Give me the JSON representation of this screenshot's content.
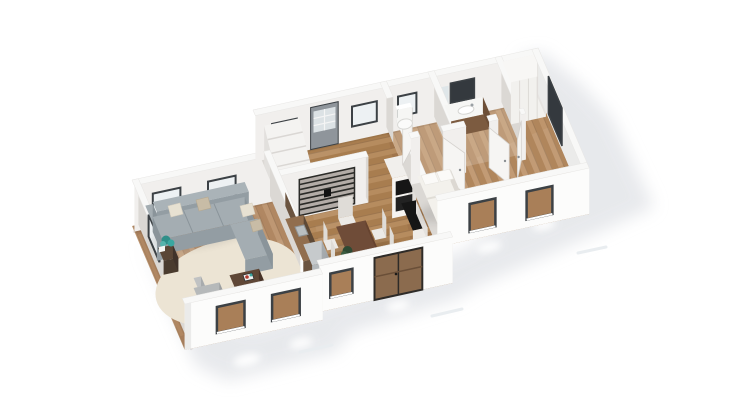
{
  "scene": {
    "title": "3D isometric floor plan rendering of a single-story home",
    "view": "birds-eye axonometric cutaway",
    "background": "#ffffff"
  },
  "rooms": [
    {
      "id": "living-room",
      "furniture": [
        "corner-sofa",
        "throw-pillows",
        "coffee-table",
        "armchair",
        "area-rug",
        "side-table",
        "plant"
      ],
      "windows": 6
    },
    {
      "id": "entry-hall",
      "furniture": [
        "front-door",
        "doormat",
        "staircase"
      ],
      "windows": 2
    },
    {
      "id": "kitchen",
      "furniture": [
        "counter-with-sink",
        "refrigerator",
        "wall-cabinet",
        "oven-column",
        "black-countertop",
        "metal-slat-screen"
      ],
      "windows": 0
    },
    {
      "id": "dining-area",
      "furniture": [
        "dining-table",
        "six-chairs",
        "floor-plant"
      ],
      "windows": 2,
      "doors": [
        "glazed-double-door"
      ]
    },
    {
      "id": "wc",
      "furniture": [
        "toilet"
      ],
      "windows": 1
    },
    {
      "id": "bathroom",
      "furniture": [
        "vanity-with-sink",
        "mirror"
      ],
      "windows": 1
    },
    {
      "id": "bedroom",
      "furniture": [
        "double-bed",
        "pillows",
        "wardrobe",
        "white-rug"
      ],
      "windows": 3
    }
  ],
  "palette": {
    "bg": "#ffffff",
    "shadow": "#e2e4e8",
    "wall-top": "#f8f8f7",
    "wall-edge": "#e8e7e5",
    "wall-face-light": "#f1efed",
    "wall-face-shade": "#dbd8d4",
    "wall-ext": "#fcfcfb",
    "wall-ext-side": "#ebebea",
    "floor-living": "#b9906a",
    "floor-mid": "#b08455",
    "floor-right": "#b98e63",
    "window-frame": "#3c4145",
    "window-glass-bright": "#edf1f3",
    "window-glass-dark": "#34393e",
    "window-interior-wood": "#a97f58",
    "door-gray": "#8f959b",
    "door-leaf": "#f6f5f3",
    "sofa": "#a4adb2",
    "sofa-shade": "#939da3",
    "sofa-dark": "#8a949a",
    "pillow": "#e7e1d2",
    "pillow-tan": "#c8bca6",
    "rug": "#ece4d4",
    "wood-dark": "#5f4736",
    "wood-darker": "#4e3a2c",
    "armchair": "#b6b9ba",
    "table-top": "#6f4c38",
    "table-edge": "#5c3d2b",
    "chair": "#eceae6",
    "chair-shade": "#dfdcd7",
    "counter-top": "#916e4e",
    "counter-body": "#6b5440",
    "fridge": "#b4b9bc",
    "fridge-side": "#a6abae",
    "black": "#161616",
    "unit-white": "#f1efec",
    "vanity": "#7c5b40",
    "vanity-side": "#6d4f37",
    "wardrobe": "#f2f1ee",
    "bed-top": "#f3f1ec",
    "bed-side": "#e8e5e0",
    "bed-side2": "#dcd8d2",
    "mat": "#c7b190",
    "stair": "#f4f3f1",
    "stair-shade": "#dad7d4",
    "stair-side": "#e2e0dd",
    "plant-teal": "#3aa7a0",
    "accent-red": "#b03a2e"
  }
}
